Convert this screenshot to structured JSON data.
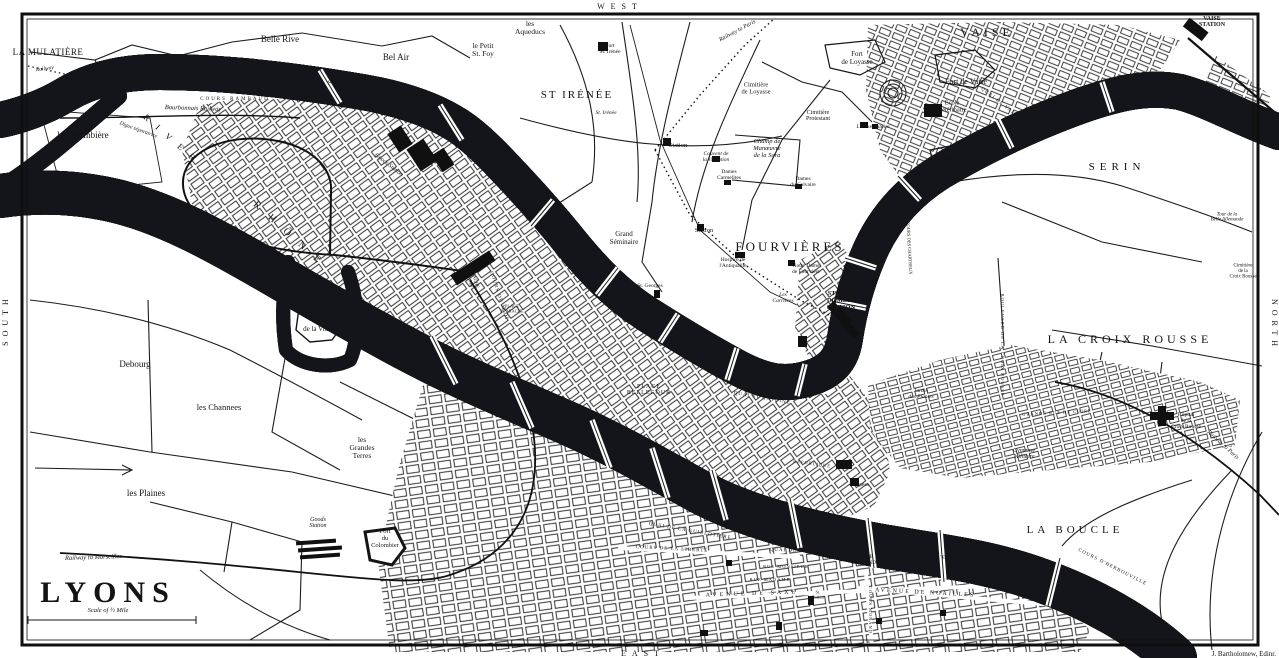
{
  "map": {
    "title": "LYONS",
    "scale_note": "Scale of ½ Mile",
    "attribution": "J. Bartholomew, Edinr.",
    "compass": {
      "top": "WEST",
      "bottom": "EAST",
      "left": "SOUTH",
      "right": "NORTH"
    },
    "colors": {
      "paper": "#ffffff",
      "water": "#c8caee",
      "water_shade": "#a9abdd",
      "ink": "#1a1a1a"
    },
    "rivers": [
      "River Saône",
      "River Rhône"
    ],
    "labels": [
      {
        "id": "label-river-saone-1",
        "t": "RIVER",
        "x": 160,
        "y": 76,
        "s": 9.5,
        "r": 2,
        "ls": 16,
        "a": "start"
      },
      {
        "id": "label-river-saone-2",
        "t": "SAÔNE",
        "x": 327,
        "y": 82,
        "s": 10.5,
        "r": 13,
        "ls": 18,
        "a": "start"
      },
      {
        "id": "label-river-rhone-1",
        "t": "RIVER",
        "x": 143,
        "y": 118,
        "s": 8.5,
        "r": 41,
        "ls": 10,
        "a": "start"
      },
      {
        "id": "label-river-rhone-2",
        "t": "RHÔNE",
        "x": 253,
        "y": 205,
        "s": 10,
        "r": 42,
        "ls": 13,
        "a": "start"
      },
      {
        "id": "label-la-mulatiere",
        "t": "LA MULATIÈRE",
        "x": 48,
        "y": 55,
        "s": 9,
        "ls": 0.5
      },
      {
        "id": "label-railway-topleft",
        "t": "Railway",
        "x": 45,
        "y": 70,
        "s": 5.5,
        "r": -8,
        "f": "i"
      },
      {
        "id": "label-belle-rive",
        "t": "Belle Rive",
        "x": 280,
        "y": 42,
        "s": 9
      },
      {
        "id": "label-bel-air",
        "t": "Bel Air",
        "x": 396,
        "y": 60,
        "s": 9
      },
      {
        "id": "label-le-petit-st-foy",
        "t": "le Petit\nSt. Foy",
        "x": 483,
        "y": 52,
        "s": 7.5
      },
      {
        "id": "label-les-aqueducs",
        "t": "les\nAqueducs",
        "x": 530,
        "y": 30,
        "s": 7.5
      },
      {
        "id": "label-fort-st-irenee",
        "t": "Fort\nSt. Irénée",
        "x": 610,
        "y": 50,
        "s": 5.5
      },
      {
        "id": "label-st-irenee",
        "t": "ST IRÉNÉE",
        "x": 577,
        "y": 98,
        "s": 11,
        "ls": 2
      },
      {
        "id": "label-st-irenee-church",
        "t": "St. Irénée",
        "x": 606,
        "y": 114,
        "s": 5.5,
        "f": "i"
      },
      {
        "id": "label-railway-to-paris-top",
        "t": "Railway to Paris",
        "x": 738,
        "y": 32,
        "s": 6,
        "r": -28,
        "f": "i"
      },
      {
        "id": "label-cimitiere-de-loyasse",
        "t": "Cimitière\nde Loyasse",
        "x": 756,
        "y": 90,
        "s": 6.5
      },
      {
        "id": "label-cimitiere-protestant",
        "t": "Cimitière\nProtestant",
        "x": 818,
        "y": 117,
        "s": 6
      },
      {
        "id": "label-fort-de-loyasse",
        "t": "Fort\nde Loyasse",
        "x": 857,
        "y": 60,
        "s": 7
      },
      {
        "id": "label-fort-de-vaise",
        "t": "Fort de Vaise",
        "x": 966,
        "y": 84,
        "s": 8
      },
      {
        "id": "label-vaise",
        "t": "VAISE",
        "x": 987,
        "y": 36,
        "s": 12,
        "ls": 4
      },
      {
        "id": "label-vaise-station",
        "t": "VAISE\nSTATION",
        "x": 1212,
        "y": 23,
        "s": 6,
        "f": "b"
      },
      {
        "id": "label-quai-de-vaise",
        "t": "QUAI DE VAISE",
        "x": 1000,
        "y": 104,
        "s": 5,
        "r": 38,
        "ls": 1
      },
      {
        "id": "label-ecole-veterinaire",
        "t": "École\nVétérinaire",
        "x": 952,
        "y": 108,
        "s": 6.5
      },
      {
        "id": "label-observatoire",
        "t": "L'Observatoire",
        "x": 873,
        "y": 128,
        "s": 5.5,
        "f": "i"
      },
      {
        "id": "label-fort-st-jean",
        "t": "Fort\nSt. Jean",
        "x": 948,
        "y": 163,
        "s": 5.5
      },
      {
        "id": "label-serin",
        "t": "SERIN",
        "x": 1117,
        "y": 170,
        "s": 11,
        "ls": 5
      },
      {
        "id": "label-tour-belle-allemande",
        "t": "Tour de la\nBelle Allemande",
        "x": 1227,
        "y": 218,
        "s": 5,
        "f": "i"
      },
      {
        "id": "label-cimitiere-croix-rousse",
        "t": "Cimitière\nde la\nCroix Rousse",
        "x": 1243,
        "y": 272,
        "s": 5
      },
      {
        "id": "label-la-croix-rousse",
        "t": "LA CROIX ROUSSE",
        "x": 1130,
        "y": 343,
        "s": 12,
        "ls": 4
      },
      {
        "id": "label-hopital-croix-rousse",
        "t": "Hôpital\nde la\nCroix Rousse",
        "x": 1186,
        "y": 422,
        "s": 5.5
      },
      {
        "id": "label-railway-to-paris-right",
        "t": "Railway to Paris",
        "x": 1222,
        "y": 446,
        "s": 6,
        "r": 42,
        "f": "i"
      },
      {
        "id": "label-grande-rue-de-cuire",
        "t": "GRANDE RUE DE CUIRE",
        "x": 1057,
        "y": 414,
        "s": 4.5,
        "r": -3,
        "ls": 1
      },
      {
        "id": "label-boulevard-croix-rousse",
        "t": "BOULEVARD DE LA CROIX ROUSSE",
        "x": 1001,
        "y": 345,
        "s": 4.5,
        "r": 90,
        "ls": 1
      },
      {
        "id": "label-cours-des-chartreux",
        "t": "COURS DES CHARTREUX",
        "x": 908,
        "y": 248,
        "s": 4.5,
        "r": 87
      },
      {
        "id": "label-champ-de-manoeuvre",
        "t": "Champ de\nManœuvre\nde la Sara",
        "x": 767,
        "y": 150,
        "s": 6.5,
        "f": "i"
      },
      {
        "id": "label-dames-du-calvaire",
        "t": "Dames\ndu Calvaire",
        "x": 803,
        "y": 183,
        "s": 5.5
      },
      {
        "id": "label-dames-carmelites",
        "t": "Dames\nCarmelites",
        "x": 729,
        "y": 176,
        "s": 5.5
      },
      {
        "id": "label-couvent-visitation",
        "t": "Couvent de\nla Visitation",
        "x": 716,
        "y": 158,
        "s": 5.5,
        "f": "i"
      },
      {
        "id": "label-station-hill",
        "t": "Station",
        "x": 678,
        "y": 147,
        "s": 6.5
      },
      {
        "id": "label-station-hill-2",
        "t": "Station",
        "x": 704,
        "y": 232,
        "s": 6.5
      },
      {
        "id": "label-grand-seminaire",
        "t": "Grand\nSéminaire",
        "x": 624,
        "y": 240,
        "s": 7
      },
      {
        "id": "label-fourvieres",
        "t": "FOURVIÈRES",
        "x": 790,
        "y": 251,
        "s": 13,
        "ls": 3
      },
      {
        "id": "label-notre-dame-de-fourviere",
        "t": "Notre Dame\nde Fourvière",
        "x": 806,
        "y": 270,
        "s": 5.5
      },
      {
        "id": "label-hospice-antiquaille",
        "t": "Hospice de\nl'Antiquaille",
        "x": 733,
        "y": 264,
        "s": 5.5
      },
      {
        "id": "label-les-carrieres",
        "t": "Les\nCarrières",
        "x": 783,
        "y": 299,
        "s": 5.5,
        "f": "i"
      },
      {
        "id": "label-st-paul-dombes-station",
        "t": "ST PAUL\nDOMBES\nSTATION",
        "x": 841,
        "y": 302,
        "s": 6.5,
        "f": "b"
      },
      {
        "id": "label-st-georges",
        "t": "St. Georges",
        "x": 650,
        "y": 287,
        "s": 5.5
      },
      {
        "id": "label-la-colombiere",
        "t": "la Colombière",
        "x": 83,
        "y": 138,
        "s": 9
      },
      {
        "id": "label-fort-vitriolerie",
        "t": "Fort\nde la Vitriolerie",
        "x": 325,
        "y": 327,
        "s": 7
      },
      {
        "id": "label-debourg",
        "t": "Debourg",
        "x": 135,
        "y": 367,
        "s": 9
      },
      {
        "id": "label-les-channees",
        "t": "les Channees",
        "x": 219,
        "y": 410,
        "s": 8.5
      },
      {
        "id": "label-les-grandes-terres",
        "t": "les\nGrandes\nTerres",
        "x": 362,
        "y": 450,
        "s": 7.5
      },
      {
        "id": "label-les-plaines",
        "t": "les Plaines",
        "x": 146,
        "y": 496,
        "s": 9
      },
      {
        "id": "label-fort-du-colombier",
        "t": "Fort\ndu\nColombier",
        "x": 385,
        "y": 540,
        "s": 6.5
      },
      {
        "id": "label-goods-station-south",
        "t": "Goods\nStation",
        "x": 318,
        "y": 524,
        "s": 6,
        "f": "i"
      },
      {
        "id": "label-goods-station-perrache",
        "t": "Goods Station",
        "x": 388,
        "y": 166,
        "s": 6,
        "r": 38,
        "f": "i"
      },
      {
        "id": "label-railway-to-marseilles",
        "t": "Railway to Marseilles",
        "x": 65,
        "y": 560,
        "s": 6.5,
        "r": -2,
        "f": "i",
        "a": "start"
      },
      {
        "id": "label-bourbonnais-railway",
        "t": "Bourbonnais Railway",
        "x": 193,
        "y": 110,
        "s": 6.5,
        "r": 2,
        "f": "i"
      },
      {
        "id": "label-digue-separatrice",
        "t": "Digue séparatrice",
        "x": 138,
        "y": 131,
        "s": 5.5,
        "r": 20,
        "f": "i"
      },
      {
        "id": "label-cours-rambaud",
        "t": "COURS RAMBAUD",
        "x": 235,
        "y": 100,
        "s": 5,
        "ls": 2
      },
      {
        "id": "label-perrache-station",
        "t": "PERRACHE\nSTATION",
        "x": 470,
        "y": 277,
        "s": 5,
        "r": 72
      },
      {
        "id": "label-cours-du-midi",
        "t": "COURS DU MIDI",
        "x": 498,
        "y": 296,
        "s": 5,
        "r": 72,
        "ls": 1
      },
      {
        "id": "label-place-perrache",
        "t": "PLACE\nPERRACHE",
        "x": 512,
        "y": 310,
        "s": 4.5
      },
      {
        "id": "label-place-bellecour",
        "t": "PLACE\nBELLECOUR",
        "x": 649,
        "y": 391,
        "s": 6,
        "ls": 1
      },
      {
        "id": "label-quai-st-antoine",
        "t": "QUAI ST ANTOINE",
        "x": 762,
        "y": 399,
        "s": 5,
        "r": 10,
        "ls": 1
      },
      {
        "id": "label-rue-republique",
        "t": "RÉPUBLIQUE",
        "x": 812,
        "y": 465,
        "s": 4.5,
        "r": 8,
        "ls": 1
      },
      {
        "id": "label-opera",
        "t": "Opéra",
        "x": 862,
        "y": 486,
        "s": 5.5
      },
      {
        "id": "label-jardin-des-plantes",
        "t": "Jardin\ndes Plantes",
        "x": 921,
        "y": 395,
        "s": 5.5,
        "f": "i"
      },
      {
        "id": "label-gymnase-militaire",
        "t": "Gymnase\nMilitaire",
        "x": 1024,
        "y": 455,
        "s": 6,
        "f": "i"
      },
      {
        "id": "label-la-boucle",
        "t": "LA BOUCLE",
        "x": 1075,
        "y": 533,
        "s": 11,
        "ls": 4
      },
      {
        "id": "label-cours-herbouville",
        "t": "COURS D'HERBOUVILLE",
        "x": 1112,
        "y": 568,
        "s": 5,
        "r": 27,
        "ls": 1
      },
      {
        "id": "label-quai-guillotiere",
        "t": "QUAI DE LA GUILLOTIÈRE",
        "x": 690,
        "y": 532,
        "s": 5,
        "r": 10,
        "ls": 1
      },
      {
        "id": "label-cours-liberte",
        "t": "COURS DE LA LIBERTÉ",
        "x": 672,
        "y": 550,
        "s": 5,
        "r": 3,
        "ls": 1
      },
      {
        "id": "label-quai-des-brotteaux",
        "t": "QUAI DES BROTTEAUX",
        "x": 806,
        "y": 552,
        "s": 5,
        "r": 2,
        "ls": 1
      },
      {
        "id": "label-place-morand",
        "t": "PLACE\nMORAND",
        "x": 864,
        "y": 561,
        "s": 5.5
      },
      {
        "id": "label-quai-de-lest",
        "t": "QUAI DE L'EST",
        "x": 930,
        "y": 557,
        "s": 5,
        "r": 8,
        "ls": 1
      },
      {
        "id": "label-rue-monsieur",
        "t": "RUE MONSIEUR",
        "x": 786,
        "y": 568,
        "s": 4.5,
        "ls": 1
      },
      {
        "id": "label-rue-madame",
        "t": "RUE MADAME",
        "x": 770,
        "y": 581,
        "s": 4.5,
        "ls": 1
      },
      {
        "id": "label-avenue-de-saxe",
        "t": "AVENUE DE SAXE",
        "x": 752,
        "y": 595,
        "s": 6,
        "r": -2,
        "ls": 3
      },
      {
        "id": "label-avenue-de-noailles",
        "t": "AVENUE DE NOAILLES",
        "x": 925,
        "y": 594,
        "s": 6,
        "r": 3,
        "ls": 2
      },
      {
        "id": "label-cours-morand",
        "t": "COURS MORAND",
        "x": 869,
        "y": 610,
        "s": 4.5,
        "r": 90,
        "ls": 1
      },
      {
        "id": "label-st-pothin",
        "t": "St.\nPothin",
        "x": 818,
        "y": 596,
        "s": 4.5
      }
    ]
  }
}
